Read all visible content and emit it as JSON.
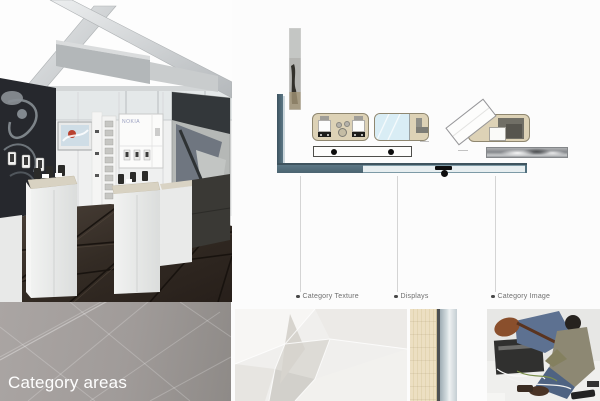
{
  "slide": {
    "title": "Category areas",
    "cabinet_brand": "NOKIA"
  },
  "callouts": [
    {
      "label": "Category Texture"
    },
    {
      "label": "Displays"
    },
    {
      "label": "Category Image"
    }
  ],
  "colors": {
    "wall_accent_teal": "#52707e",
    "counter_tan": "#ddd2b6",
    "glass_blue": "#d9edf5",
    "floor_brown": "#38302a",
    "title_panel_gray": "#a09b99",
    "label_text": "#6f6f6f",
    "title_text": "#fefefe"
  }
}
